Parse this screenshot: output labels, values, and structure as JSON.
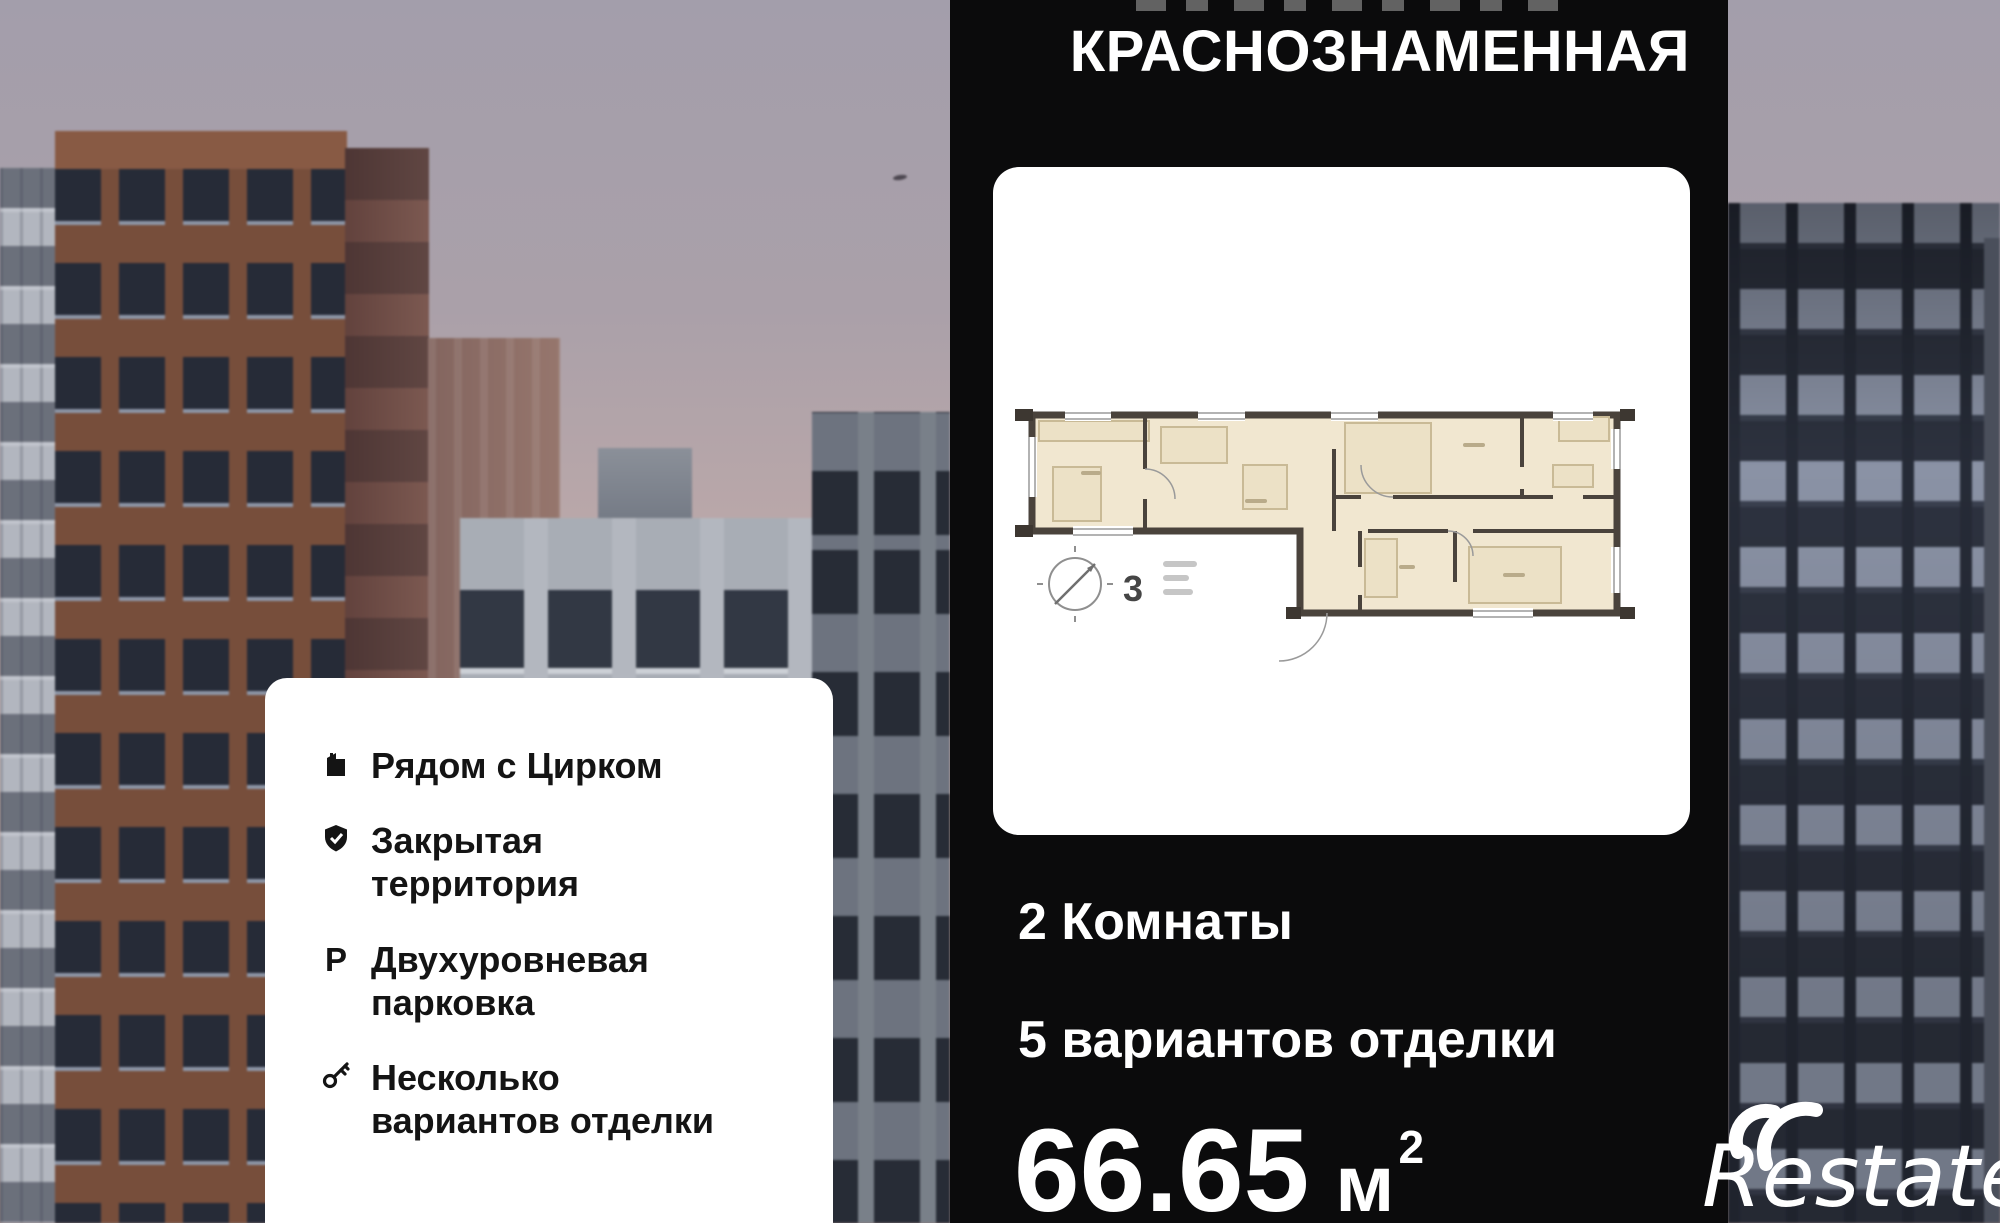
{
  "header": {
    "title": "КРАСНОЗНАМЕННАЯ"
  },
  "floorplan": {
    "label": "3"
  },
  "stats": {
    "rooms": "2 Комнаты",
    "finishing": "5 вариантов отделки",
    "area_value": "66.65",
    "area_unit": "м",
    "area_sup": "2"
  },
  "features": [
    {
      "icon": "building-icon",
      "label": "Рядом с Цирком"
    },
    {
      "icon": "shield-check-icon",
      "label": "Закрытая\nтерритория"
    },
    {
      "icon": "parking-icon",
      "glyph": "Р",
      "label": "Двухуровневая\nпарковка"
    },
    {
      "icon": "key-icon",
      "label": "Несколько\nвариантов отделки"
    }
  ],
  "logo": {
    "text": "Restate"
  },
  "colors": {
    "panel": "#0b0b0c",
    "card": "#ffffff",
    "plan_room_fill": "#f1e7d0",
    "plan_wall": "#4a433c",
    "text_light": "#ffffff",
    "text_dark": "#141414"
  }
}
